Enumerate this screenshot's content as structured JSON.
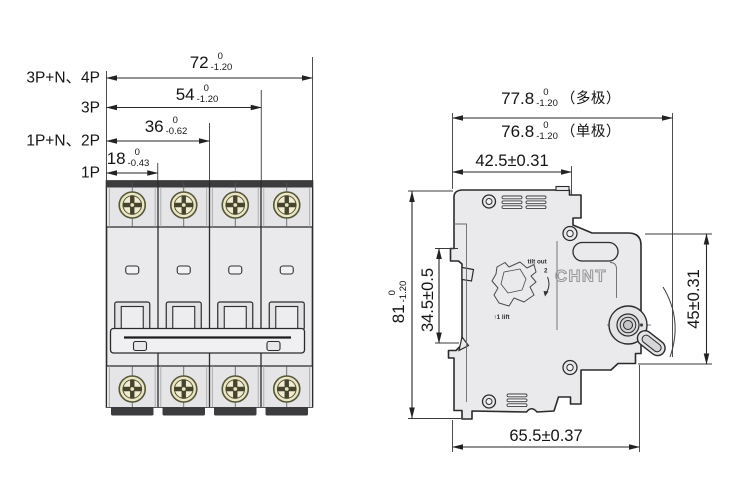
{
  "colors": {
    "background": "#ffffff",
    "outline": "#2b2b2b",
    "body_fill": "#eaeaec",
    "dark_trim": "#3c3c3e",
    "screw_brass": "#eae6c6",
    "dimension_text": "#141414"
  },
  "front_view": {
    "rows": [
      {
        "label": "3P+N、4P",
        "value": "72",
        "tol_upper": "0",
        "tol_lower": "-1.20"
      },
      {
        "label": "3P",
        "value": "54",
        "tol_upper": "0",
        "tol_lower": "-1.20"
      },
      {
        "label": "1P+N、2P",
        "value": "36",
        "tol_upper": "0",
        "tol_lower": "-0.62"
      },
      {
        "label": "1P",
        "value": "18",
        "tol_upper": "0",
        "tol_lower": "-0.43"
      }
    ]
  },
  "side_view": {
    "depth_total_multi": {
      "value": "77.8",
      "tol_upper": "0",
      "tol_lower": "-1.20",
      "note": "（多极）"
    },
    "depth_total_single": {
      "value": "76.8",
      "tol_upper": "0",
      "tol_lower": "-1.20",
      "note": "（单极）"
    },
    "depth_to_rail": "42.5±0.31",
    "overall_height": {
      "value": "81",
      "tol_upper": "0",
      "tol_lower": "-1.20"
    },
    "rail_notch_height": "34.5±0.5",
    "front_face_height": "45±0.31",
    "base_depth": "65.5±0.37",
    "logo": "CHNT",
    "mount_notes": {
      "tilt": "tilt out",
      "tilt_step": "2",
      "lift": "↑1  lift"
    }
  }
}
